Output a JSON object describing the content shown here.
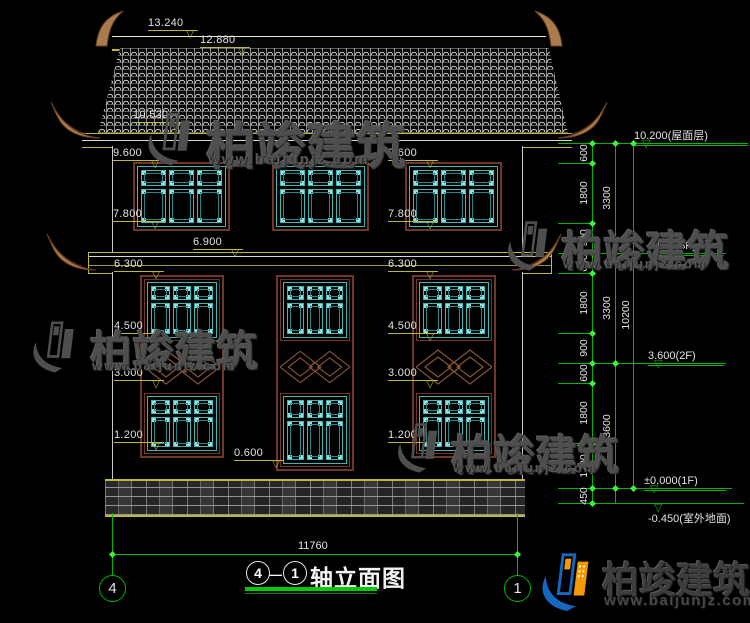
{
  "drawing": {
    "type": "elevation",
    "overall_width_dim": "11760",
    "sill_dim": "0.600"
  },
  "left_labels": [
    "13.240",
    "12.880",
    "10.530",
    "9.600",
    "7.800",
    "6.900",
    "6.300",
    "4.500",
    "3.000",
    "1.200",
    "0.600"
  ],
  "center_labels": [
    "9.600",
    "7.800",
    "6.300",
    "4.500",
    "3.000",
    "1.200"
  ],
  "right_dims": {
    "col1": [
      "600",
      "1800",
      "900",
      "600",
      "1800",
      "900",
      "600",
      "1800",
      "1200",
      "450"
    ],
    "col2": [
      "3300",
      "3300",
      "3600"
    ],
    "col3": [
      "10200"
    ]
  },
  "levels": [
    "10.200(屋面层)",
    "6.900(3F)",
    "3.600(2F)",
    "±0.000(1F)",
    "-0.450(室外地面)"
  ],
  "bottom": {
    "overall_dim": "11760",
    "grid_left": "4",
    "grid_right": "1",
    "title_axis_left": "4",
    "title_axis_right": "1",
    "title_separator": "—",
    "title_text": "轴立面图"
  },
  "watermark": {
    "brand": "柏竣建筑",
    "url": "www.baijunjz.com"
  },
  "footer": {
    "brand": "柏竣建筑",
    "url": "www.baijunjz.com"
  },
  "colors": {
    "background": "#000000",
    "line_white": "#e2e2e2",
    "dim_yellow": "#bdb836",
    "dim_green": "#00b600",
    "tick_green": "#3cf23c",
    "window_teal": "#41b6b6",
    "frame_brown": "#703728",
    "ornament_brown": "#8a5434",
    "eave_curl": "#a97c4e",
    "watermark_gray": "#4e4e4e",
    "logo_blue": "#1567c0",
    "logo_orange": "#f59a00",
    "title_underline": "#00cc00"
  }
}
